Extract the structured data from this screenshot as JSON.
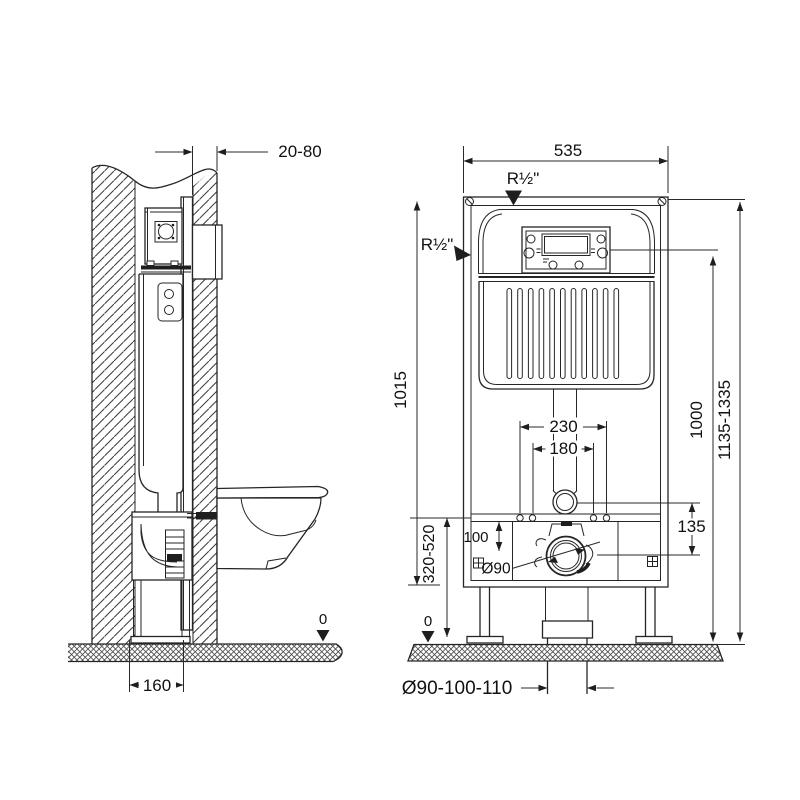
{
  "side_view": {
    "clearance": "20-80",
    "frame_depth": "160",
    "floor_zero": "0"
  },
  "front_view": {
    "frame_width": "535",
    "water_conn_top": "R½\"",
    "water_conn_side": "R½\"",
    "frame_height": "1015",
    "actuation_height": "1000",
    "total_height": "1135-1335",
    "fixing_distance_outer": "230",
    "fixing_distance_inner": "180",
    "inlet_to_outlet": "135",
    "rail_offset": "100",
    "outlet_height_range": "320-520",
    "outlet_diameter": "Ø90",
    "floor_zero": "0",
    "drain_pipe_diameter": "Ø90-100-110"
  },
  "colors": {
    "line": "#252525",
    "background": "#ffffff"
  }
}
